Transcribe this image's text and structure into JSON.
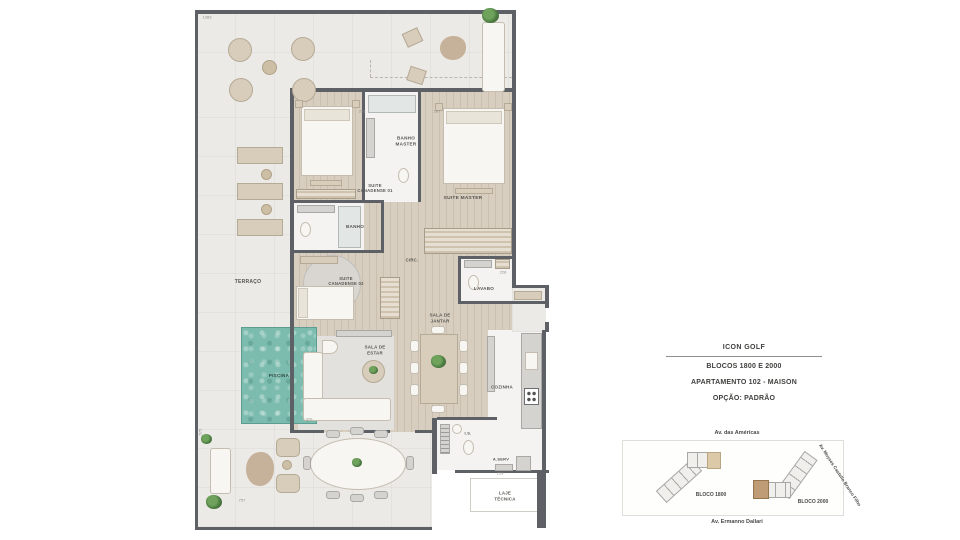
{
  "title_block": {
    "project": "ICON GOLF",
    "blocks": "BLOCOS 1800 E 2000",
    "unit": "APARTAMENTO 102 - MAISON",
    "option": "OPÇÃO: PADRÃO"
  },
  "site_plan": {
    "street_top": "Av. das Américas",
    "street_right": "Av. Moyses Castello Branco Filho",
    "street_bottom": "Av. Ermanno Dallari",
    "bloco_left": "BLOCO 1800",
    "bloco_right": "BLOCO 2000",
    "highlight_left_color": "#dbc9a7",
    "highlight_right_color": "#bf9b76"
  },
  "plan": {
    "colors": {
      "wall": "#5d6165",
      "wood_floor": "#d8cec0",
      "terrace_floor": "#eceae7",
      "pool_water": "#7cbcae",
      "room_white": "#f4f3f1",
      "furniture_beige": "#d8cdba",
      "plant_green": "#5b8a4d"
    },
    "labels": [
      {
        "name": "terraco",
        "text": "TERRAÇO",
        "x": 248,
        "y": 282,
        "fs": 5
      },
      {
        "name": "banho-master",
        "text": "BANHO\nMASTER",
        "x": 406,
        "y": 141,
        "fs": 4.6
      },
      {
        "name": "suite-canadense-01",
        "text": "SUITE\nCANADENSE 01",
        "x": 375,
        "y": 188,
        "fs": 4.2
      },
      {
        "name": "suite-master",
        "text": "SUITE MASTER",
        "x": 463,
        "y": 199,
        "fs": 4.8
      },
      {
        "name": "banho",
        "text": "BANHO",
        "x": 355,
        "y": 227,
        "fs": 4.6
      },
      {
        "name": "suite-canadense-02",
        "text": "SUITE\nCANADENSE 02",
        "x": 346,
        "y": 281,
        "fs": 4.2
      },
      {
        "name": "circ",
        "text": "CIRC.",
        "x": 412,
        "y": 260,
        "fs": 4.2
      },
      {
        "name": "lavabo",
        "text": "LAVABO",
        "x": 484,
        "y": 289,
        "fs": 4.6
      },
      {
        "name": "sala-de-jantar",
        "text": "SALA DE\nJANTAR",
        "x": 440,
        "y": 318,
        "fs": 4.4
      },
      {
        "name": "sala-de-estar",
        "text": "SALA DE\nESTAR",
        "x": 375,
        "y": 350,
        "fs": 4.4
      },
      {
        "name": "piscina",
        "text": "PISCINA",
        "x": 279,
        "y": 376,
        "fs": 4.6,
        "color": "#2f4a44"
      },
      {
        "name": "cozinha",
        "text": "COZINHA",
        "x": 502,
        "y": 387,
        "fs": 4.4
      },
      {
        "name": "is",
        "text": "I.S.",
        "x": 468,
        "y": 433,
        "fs": 4
      },
      {
        "name": "a-serv",
        "text": "A.SERV",
        "x": 501,
        "y": 459,
        "fs": 4
      },
      {
        "name": "laje-tecnica",
        "text": "LAJE\nTÉCNICA",
        "x": 505,
        "y": 496,
        "fs": 4.4
      }
    ],
    "dims": [
      {
        "text": "1383",
        "x": 207,
        "y": 17,
        "rot": 0
      },
      {
        "text": "293",
        "x": 362,
        "y": 111,
        "rot": 0
      },
      {
        "text": "287",
        "x": 437,
        "y": 111,
        "rot": 0
      },
      {
        "text": "228",
        "x": 503,
        "y": 272,
        "rot": 0
      },
      {
        "text": "370",
        "x": 309,
        "y": 419,
        "rot": 0
      },
      {
        "text": "219",
        "x": 500,
        "y": 473,
        "rot": 0
      },
      {
        "text": "757",
        "x": 242,
        "y": 500,
        "rot": 0
      },
      {
        "text": "575",
        "x": 200,
        "y": 432,
        "rot": -90
      }
    ]
  }
}
